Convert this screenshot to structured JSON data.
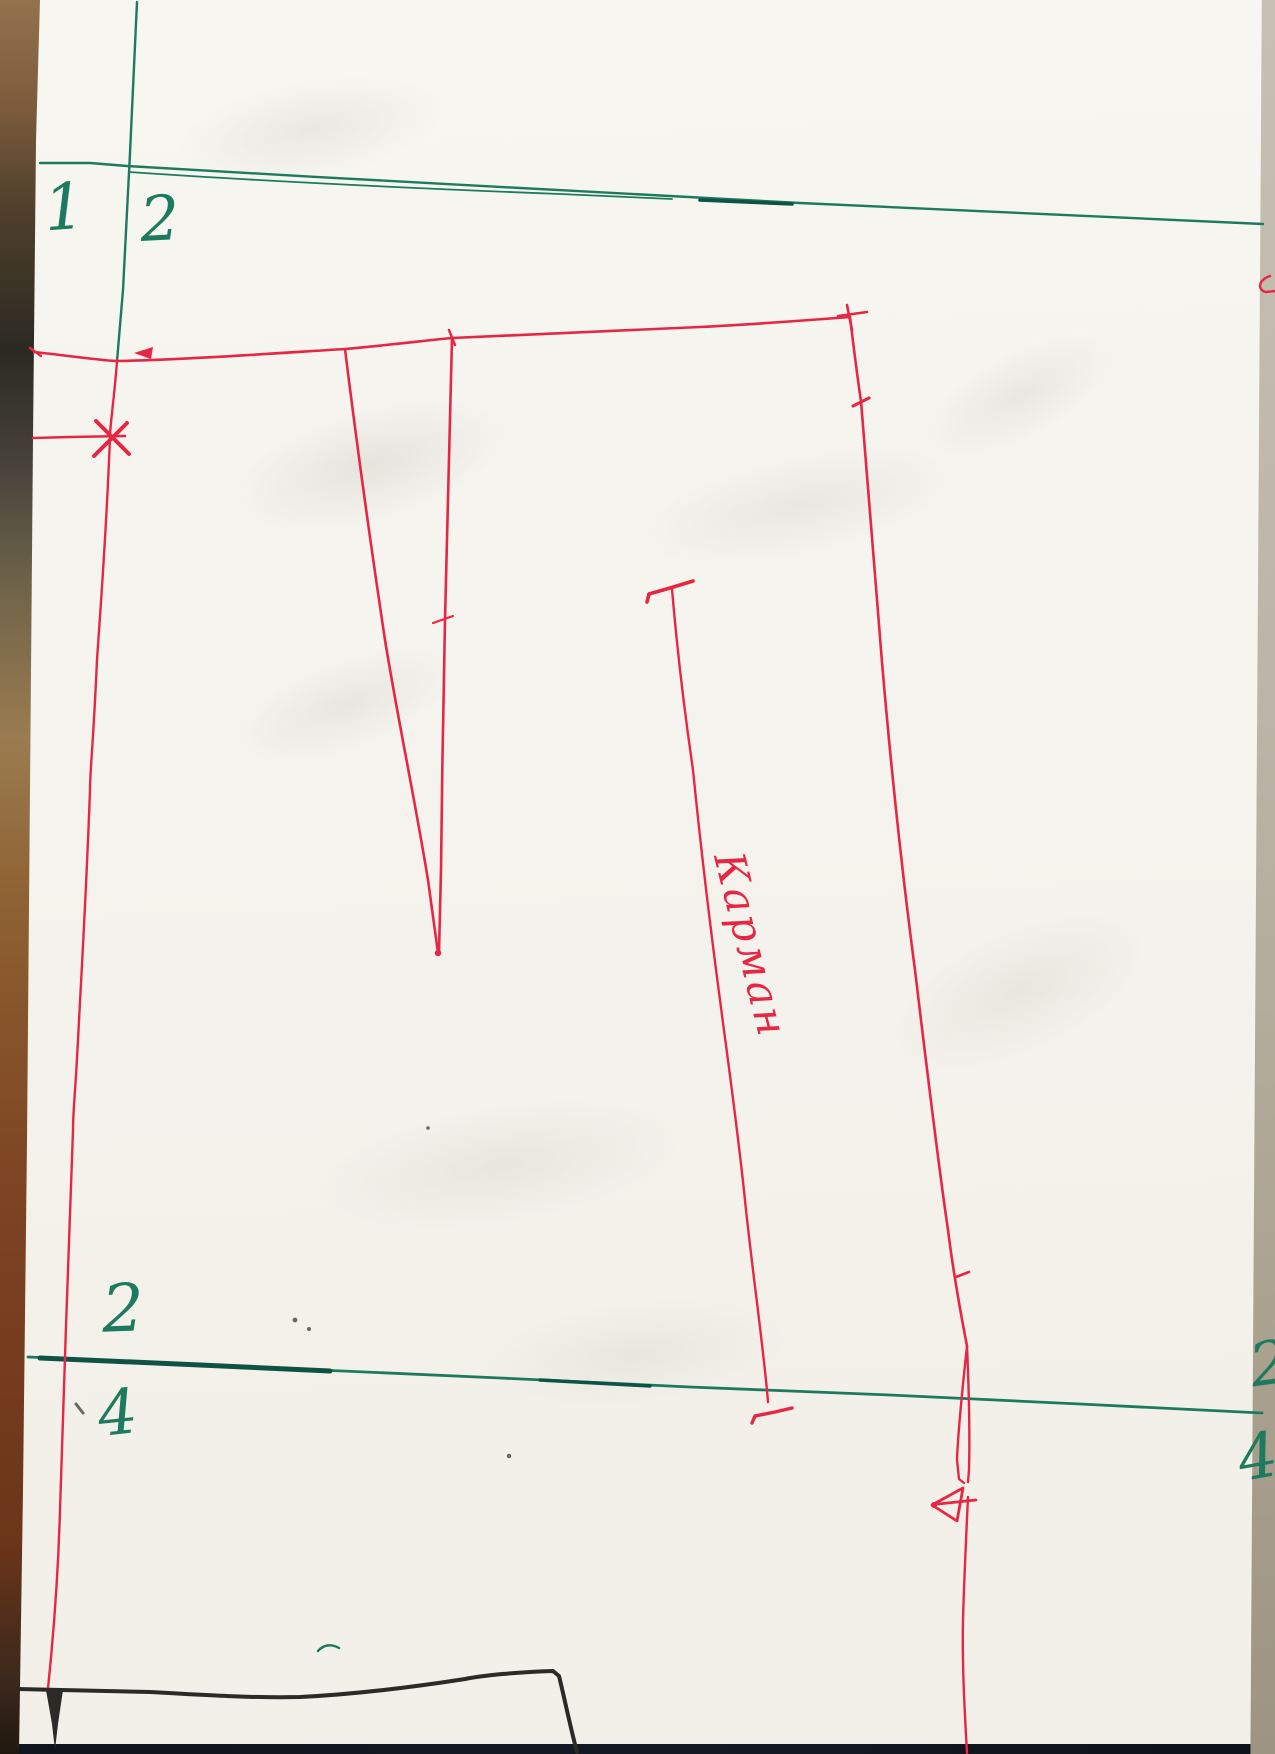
{
  "document": {
    "kind_label": "hand-drawn sewing pattern scan",
    "labels": {
      "grid_top_left_number": "1",
      "grid_top_right_number": "2",
      "grid_bottom_left_number": "2",
      "grid_bottom_left_lower_number": "4",
      "grid_right_edge_upper_number": "2",
      "grid_right_edge_lower_number": "4",
      "pocket_annotation": "Карман"
    },
    "colors": {
      "green_ink": "#1d7a5f",
      "green_ink_dark": "#0e5243",
      "red_ink": "#e62744",
      "black_ink": "#2b2a26",
      "speck_gray": "#6a675f",
      "paper": "#f6f4ee"
    }
  }
}
